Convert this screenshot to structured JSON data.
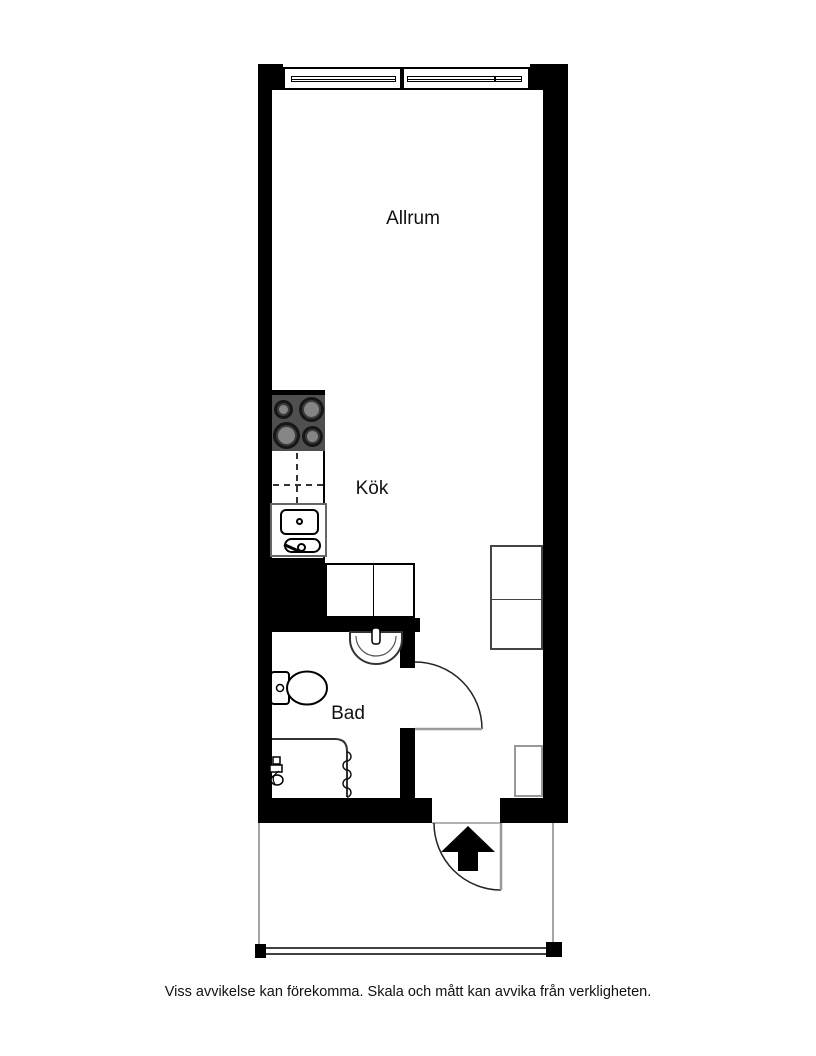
{
  "floorplan": {
    "rooms": [
      {
        "id": "allrum",
        "label": "Allrum"
      },
      {
        "id": "kok",
        "label": "Kök"
      },
      {
        "id": "bad",
        "label": "Bad"
      }
    ],
    "fixtures": [
      {
        "name": "window",
        "location": "top-wall"
      },
      {
        "name": "stove-four-burners",
        "location": "kitchen"
      },
      {
        "name": "kitchen-sink",
        "location": "kitchen"
      },
      {
        "name": "dashed-counter",
        "location": "kitchen"
      },
      {
        "name": "wardrobe-double",
        "location": "hall-left"
      },
      {
        "name": "wardrobe-double",
        "location": "hall-right"
      },
      {
        "name": "washbasin",
        "location": "bathroom"
      },
      {
        "name": "toilet",
        "location": "bathroom"
      },
      {
        "name": "shower-with-curtain",
        "location": "bathroom"
      },
      {
        "name": "bathroom-door",
        "location": "bathroom"
      },
      {
        "name": "entrance-door",
        "location": "entrance"
      },
      {
        "name": "entrance-arrow",
        "location": "entrance"
      },
      {
        "name": "shaft",
        "location": "entrance"
      },
      {
        "name": "balcony-railing",
        "location": "balcony"
      }
    ],
    "colors": {
      "wall": "#000000",
      "stove": "#4f4f4f",
      "fixture_outline": "#555555",
      "door_leaf": "#9a9a9a"
    }
  },
  "footer": {
    "disclaimer": "Viss avvikelse kan förekomma. Skala och mått kan avvika från verkligheten."
  }
}
